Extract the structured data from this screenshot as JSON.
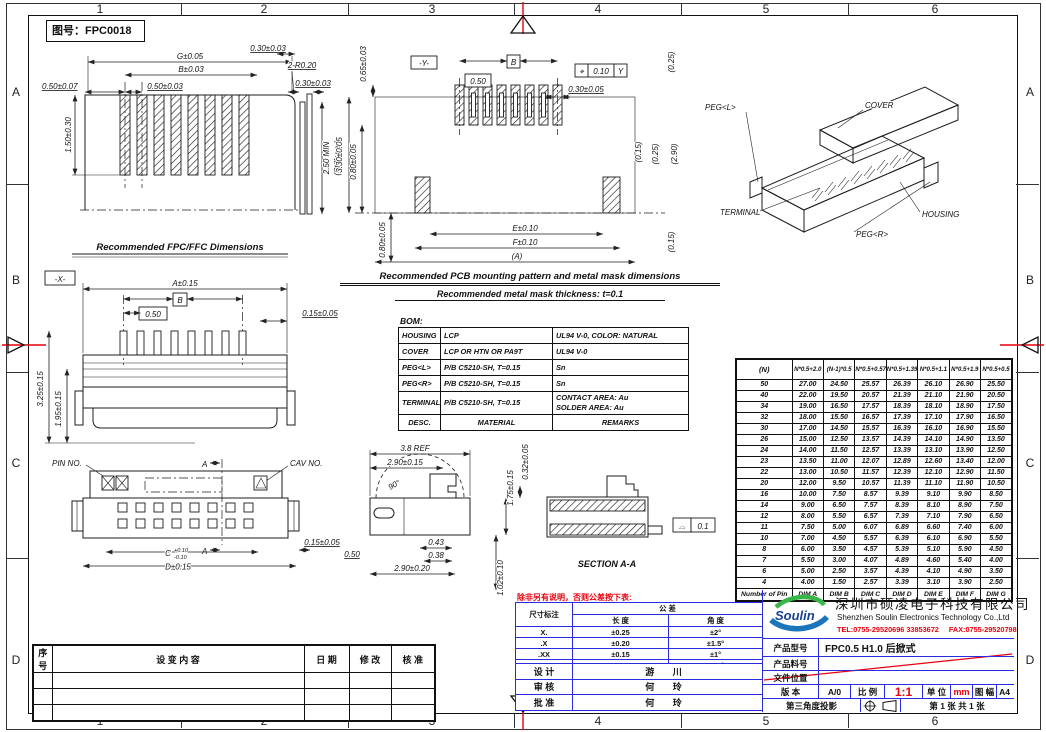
{
  "frame": {
    "drawing_no": "图号：FPC0018",
    "cols": [
      "1",
      "2",
      "3",
      "4",
      "5",
      "6"
    ],
    "rows": [
      "A",
      "B",
      "C",
      "D"
    ]
  },
  "views": {
    "fpc": {
      "caption": "Recommended FPC/FFC Dimensions",
      "g": "G±0.05",
      "b": "B±0.03",
      "p_left": "0.50±0.07",
      "pitch": "0.50±0.03",
      "edge": "0.30±0.03",
      "radius": "2-R0.20",
      "tail": "1.50±0.30",
      "stiff_t": "0.30±0.03",
      "stiff_min": "2.50 MIN",
      "stiff_name": "(Stiffener)"
    },
    "pcb": {
      "caption1": "Recommended PCB mounting pattern and metal mask dimensions",
      "caption2": "Recommended metal mask thickness: t=0.1",
      "offset": "0.65±0.03",
      "datum": "-Y-",
      "b_ref": "B",
      "pitch": "0.50",
      "fcf_sym": "⌖",
      "fcf_tol": "0.10",
      "fcf_datum": "Y",
      "pad_w": "0.30±0.05",
      "c025a": "(0.25)",
      "height": "3.30±0.05",
      "d080a": "0.80±0.05",
      "c015a": "(0.15)",
      "c025b": "(0.25)",
      "c290": "(2.90)",
      "e": "E±0.10",
      "f": "F±0.10",
      "a": "(A)",
      "d080b": "0.80±0.05",
      "c015b": "(0.15)"
    },
    "iso": {
      "peg_l": "PEG<L>",
      "cover": "COVER",
      "terminal": "TERMINAL",
      "housing": "HOUSING",
      "peg_r": "PEG<R>"
    },
    "front": {
      "datum": "-X-",
      "a": "A±0.15",
      "b_ref": "B",
      "pitch": "0.50",
      "side": "0.15±0.05",
      "h1": "3.25±0.15",
      "h2": "1.95±0.15"
    },
    "bottom": {
      "pin_no": "PIN NO.",
      "cav_no": "CAV NO.",
      "sec": "A",
      "c": "C",
      "c_plus": "+0.10",
      "c_minus": "-0.10",
      "d": "D±0.15",
      "side": "0.15±0.05",
      "p050": "0.50"
    },
    "side": {
      "ref": "3.8 REF",
      "open": "2.90±0.15",
      "angle": "90°",
      "lift": "0.32±0.05",
      "h": "1.75±0.15",
      "d043": "0.43",
      "d038": "0.38",
      "depth": "2.90±0.20",
      "tail": "1.02±0.10",
      "section": "SECTION A-A",
      "profile_sym": "⌓",
      "profile_tol": "0.1"
    }
  },
  "bom": {
    "label": "BOM:",
    "rows": [
      {
        "desc": "HOUSING",
        "mat": "LCP",
        "remarks": [
          "UL94 V-0, COLOR: NATURAL"
        ]
      },
      {
        "desc": "COVER",
        "mat": "LCP OR HTN OR PA9T",
        "remarks": [
          "UL94 V-0"
        ]
      },
      {
        "desc": "PEG<L>",
        "mat": "P/B C5210-SH, T=0.15",
        "remarks": [
          "Sn"
        ]
      },
      {
        "desc": "PEG<R>",
        "mat": "P/B C5210-SH, T=0.15",
        "remarks": [
          "Sn"
        ]
      },
      {
        "desc": "TERMINAL",
        "mat": "P/B C5210-SH, T=0.15",
        "remarks": [
          "CONTACT AREA: Au",
          "SOLDER AREA: Au"
        ]
      },
      {
        "desc": "DESC.",
        "mat": "MATERIAL",
        "remarks": [
          "REMARKS"
        ],
        "header": true
      }
    ]
  },
  "dim_table": {
    "headers": [
      "(N)",
      "N*0.5+2.0",
      "(N-1)*0.5",
      "N*0.5+0.57",
      "N*0.5+1.39",
      "N*0.5+1.1",
      "N*0.5+1.9",
      "N*0.5+0.5"
    ],
    "rows": [
      [
        "50",
        "27.00",
        "24.50",
        "25.57",
        "26.39",
        "26.10",
        "26.90",
        "25.50"
      ],
      [
        "40",
        "22.00",
        "19.50",
        "20.57",
        "21.39",
        "21.10",
        "21.90",
        "20.50"
      ],
      [
        "34",
        "19.00",
        "16.50",
        "17.57",
        "18.39",
        "18.10",
        "18.90",
        "17.50"
      ],
      [
        "32",
        "18.00",
        "15.50",
        "16.57",
        "17.39",
        "17.10",
        "17.90",
        "16.50"
      ],
      [
        "30",
        "17.00",
        "14.50",
        "15.57",
        "16.39",
        "16.10",
        "16.90",
        "15.50"
      ],
      [
        "26",
        "15.00",
        "12.50",
        "13.57",
        "14.39",
        "14.10",
        "14.90",
        "13.50"
      ],
      [
        "24",
        "14.00",
        "11.50",
        "12.57",
        "13.39",
        "13.10",
        "13.90",
        "12.50"
      ],
      [
        "23",
        "13.50",
        "11.00",
        "12.07",
        "12.89",
        "12.60",
        "13.40",
        "12.00"
      ],
      [
        "22",
        "13.00",
        "10.50",
        "11.57",
        "12.39",
        "12.10",
        "12.90",
        "11.50"
      ],
      [
        "20",
        "12.00",
        "9.50",
        "10.57",
        "11.39",
        "11.10",
        "11.90",
        "10.50"
      ],
      [
        "16",
        "10.00",
        "7.50",
        "8.57",
        "9.39",
        "9.10",
        "9.90",
        "8.50"
      ],
      [
        "14",
        "9.00",
        "6.50",
        "7.57",
        "8.39",
        "8.10",
        "8.90",
        "7.50"
      ],
      [
        "12",
        "8.00",
        "5.50",
        "6.57",
        "7.39",
        "7.10",
        "7.90",
        "6.50"
      ],
      [
        "11",
        "7.50",
        "5.00",
        "6.07",
        "6.89",
        "6.60",
        "7.40",
        "6.00"
      ],
      [
        "10",
        "7.00",
        "4.50",
        "5.57",
        "6.39",
        "6.10",
        "6.90",
        "5.50"
      ],
      [
        "8",
        "6.00",
        "3.50",
        "4.57",
        "5.39",
        "5.10",
        "5.90",
        "4.50"
      ],
      [
        "7",
        "5.50",
        "3.00",
        "4.07",
        "4.89",
        "4.60",
        "5.40",
        "4.00"
      ],
      [
        "6",
        "5.00",
        "2.50",
        "3.57",
        "4.39",
        "4.10",
        "4.90",
        "3.50"
      ],
      [
        "4",
        "4.00",
        "1.50",
        "2.57",
        "3.39",
        "3.10",
        "3.90",
        "2.50"
      ]
    ],
    "footer": [
      "Number of Pin",
      "DIM A",
      "DIM B",
      "DIM C",
      "DIM D",
      "DIM E",
      "DIM F",
      "DIM G"
    ]
  },
  "revisions": {
    "headers": [
      "序 号",
      "设 变 内 容",
      "日 期",
      "修 改",
      "核 准"
    ],
    "empty_rows": 3
  },
  "tolerance": {
    "note": "除非另有说明，否则公差按下表:",
    "dim_col": "尺寸标注",
    "tol_col": "公 差",
    "len_col": "长 度",
    "ang_col": "角 度",
    "rows": [
      [
        "X.",
        "±0.25",
        "±2°"
      ],
      [
        ".X",
        "±0.20",
        "±1.5°"
      ],
      [
        ".XX",
        "±0.15",
        "±1°"
      ],
      [
        ".XXX",
        "±0.10",
        "±0.5°"
      ]
    ]
  },
  "approvals": [
    {
      "label": "设 计",
      "name": "游 川"
    },
    {
      "label": "审 核",
      "name": "何 玲"
    },
    {
      "label": "批 准",
      "name": "何 玲"
    }
  ],
  "company": {
    "logo": "Soulin",
    "name_cn": "深圳市硕凌电子科技有限公司",
    "name_en": "Shenzhen Soulin Electronics Technology Co.,Ltd",
    "tel": "TEL:0755-29520696  33853672",
    "fax": "FAX:0755-29520798"
  },
  "fields": {
    "model_label": "产品型号",
    "model": "FPC0.5 H1.0 后掀式",
    "part_label": "产品料号",
    "part": "",
    "file_label": "文件位置",
    "file": "",
    "ver_label": "版 本",
    "ver": "A/0",
    "scale_label": "比 例",
    "scale": "1:1",
    "unit_label": "单 位",
    "unit": "mm",
    "size_label": "图 幅",
    "size": "A4",
    "proj_label": "第三角度投影",
    "sheet": "第 1 张 共 1 张"
  }
}
